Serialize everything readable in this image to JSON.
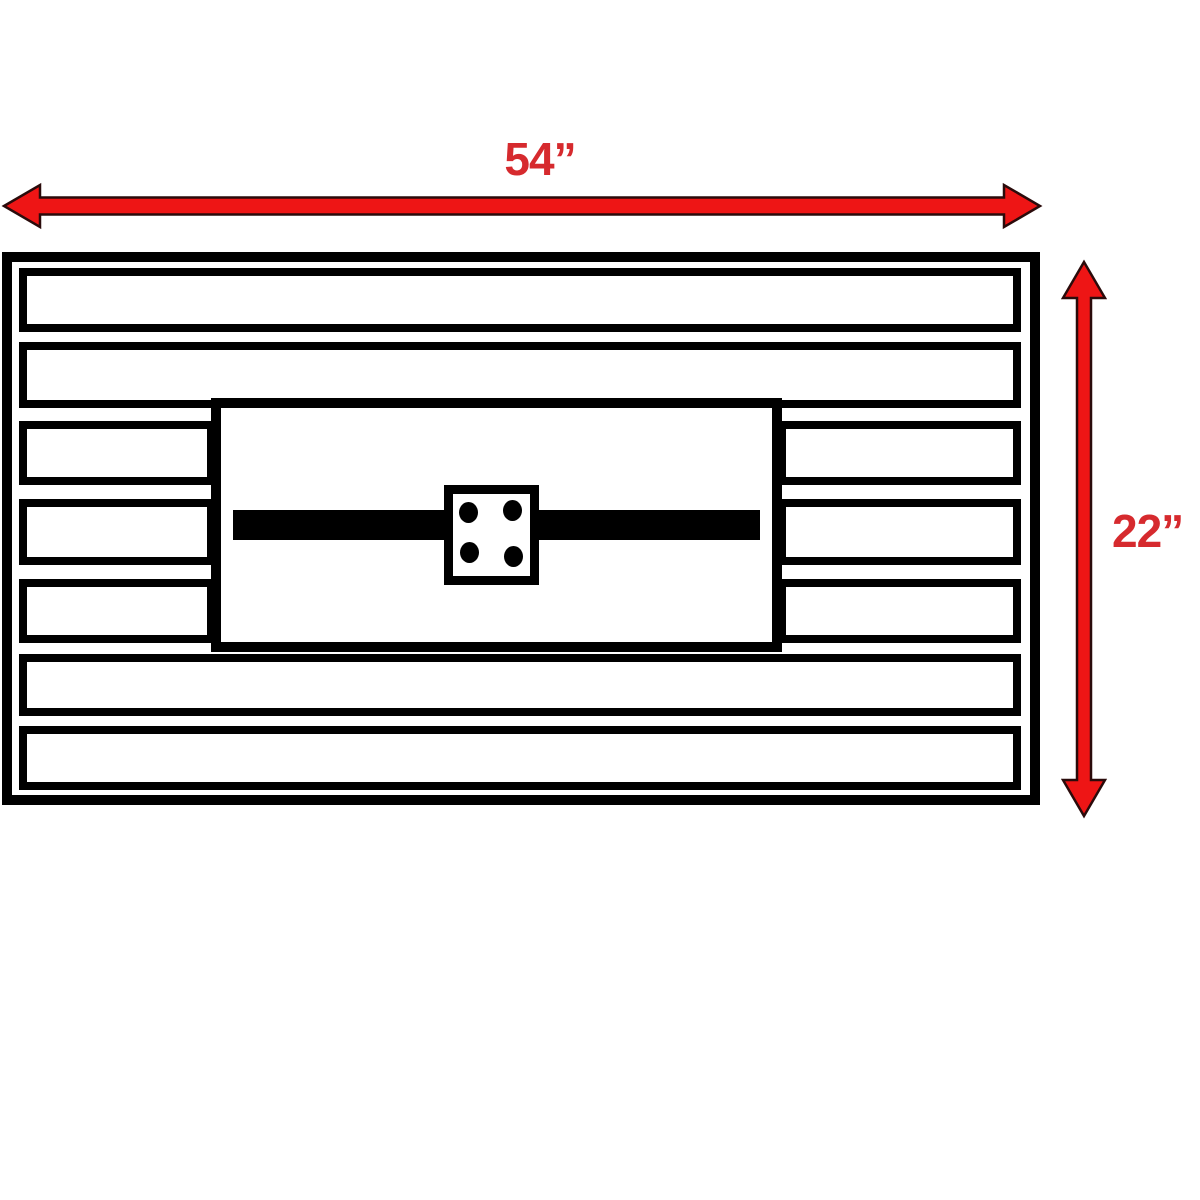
{
  "colors": {
    "accent": "#ee1515",
    "accent_dark": "#2a0b0b",
    "label": "#d62a2e",
    "line": "#000000",
    "background": "#ffffff"
  },
  "dimensions": {
    "width": {
      "label": "54”"
    },
    "height": {
      "label": "22”"
    }
  },
  "structure": {
    "full_width_slats": 4,
    "split_slat_rows": 3,
    "burner_holes": 4
  }
}
